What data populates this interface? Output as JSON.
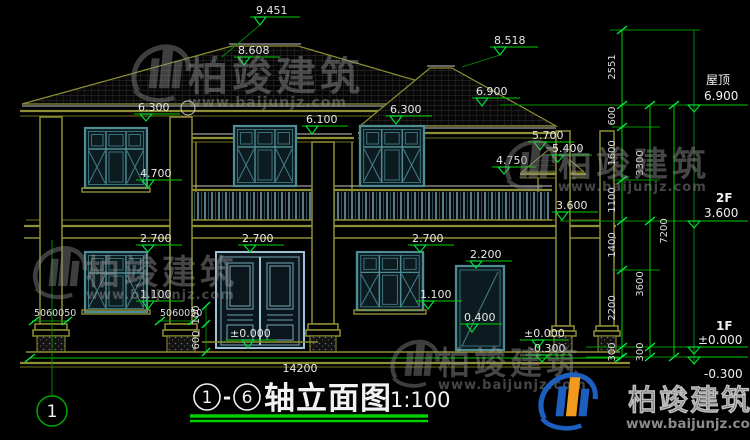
{
  "drawing": {
    "title": {
      "axis_start": "1",
      "axis_end": "6",
      "separator": "-",
      "name": "轴立面图",
      "scale": "1:100"
    },
    "axis_bubble": "1",
    "watermark": {
      "brand": "柏竣建筑",
      "url": "www.baijunjz.com"
    },
    "levels": {
      "roof_label": "屋顶",
      "roof": "6.900",
      "f2_label": "2F",
      "f2": "3.600",
      "f1_label": "1F",
      "f1": "±0.000",
      "base": "-0.300"
    },
    "elevations": {
      "ridge_main": "9.451",
      "ridge_mid": "8.608",
      "ridge_right": "8.518",
      "eave_main": "6.900",
      "eave_left": "6.300",
      "win_2f_top": "6.300",
      "porch_eave": "6.100",
      "canopy_top": "5.700",
      "canopy_mid": "5.400",
      "canopy_eave": "4.750",
      "win_2f_sill": "4.700",
      "balcony": "3.600",
      "win_1f_left_top": "2.700",
      "door_top": "2.700",
      "win_1f_right_top": "2.700",
      "side_door_top": "2.200",
      "win_1f_left_sill": "1.100",
      "win_1f_right_sill": "1.100",
      "side_step": "0.400",
      "door_level": "±0.000",
      "side_level": "±0.000",
      "side_base": "-0.300"
    },
    "dims": {
      "roof_rise": "2551",
      "chain": [
        "600",
        "1600",
        "1100",
        "1400",
        "2200",
        "300"
      ],
      "story_upper": "3300",
      "story_lower": "3600",
      "foundation": "300",
      "total_height": "7200",
      "overall_width": "14200",
      "col_base_left": "5060050",
      "col_base_right": "5060050",
      "step_a": "100",
      "step_b": "600"
    }
  }
}
